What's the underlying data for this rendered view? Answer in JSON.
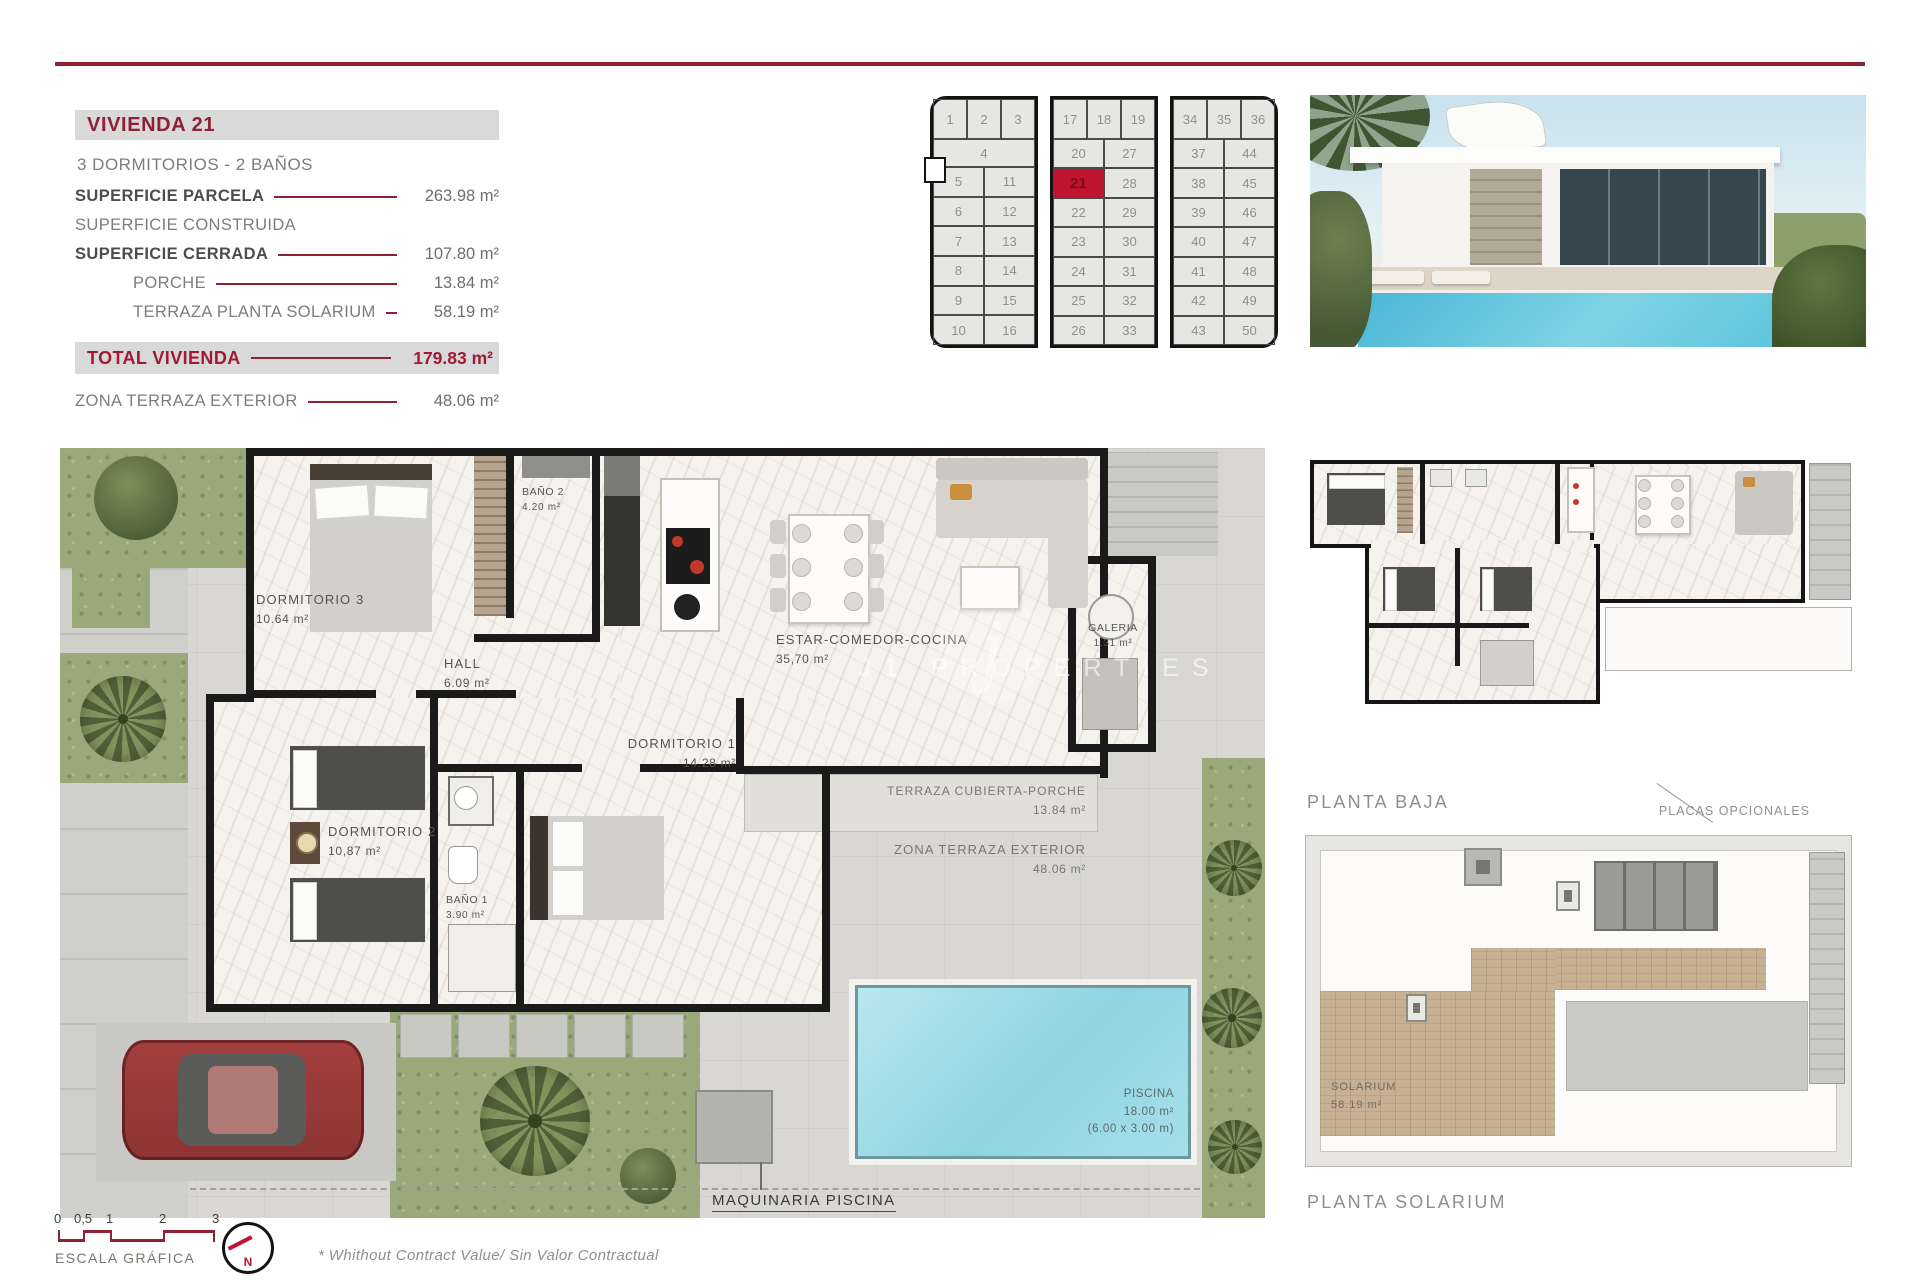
{
  "info_panel": {
    "title": "VIVIENDA 21",
    "subtitle": "3 DORMITORIOS - 2 BAÑOS",
    "rows": [
      {
        "label": "SUPERFICIE PARCELA",
        "value": "263.98 m²"
      },
      {
        "label": "SUPERFICIE CONSTRUIDA",
        "value": ""
      },
      {
        "label": "SUPERFICIE CERRADA",
        "value": "107.80 m²"
      },
      {
        "label": "PORCHE",
        "value": "13.84 m²"
      },
      {
        "label": "TERRAZA PLANTA SOLARIUM",
        "value": "58.19 m²"
      }
    ],
    "total": {
      "label": "TOTAL VIVIENDA",
      "value": "179.83 m²"
    },
    "zona": {
      "label": "ZONA TERRAZA EXTERIOR",
      "value": "48.06 m²"
    }
  },
  "plot_grid": {
    "highlight_plot": "21",
    "blocks": [
      {
        "top": [
          "1",
          "2",
          "3"
        ],
        "wide": "4",
        "pairs": [
          [
            "5",
            "11"
          ],
          [
            "6",
            "12"
          ],
          [
            "7",
            "13"
          ],
          [
            "8",
            "14"
          ],
          [
            "9",
            "15"
          ],
          [
            "10",
            "16"
          ]
        ]
      },
      {
        "top": [
          "17",
          "18",
          "19"
        ],
        "pairs": [
          [
            "20",
            "27"
          ],
          [
            "21",
            "28"
          ],
          [
            "22",
            "29"
          ],
          [
            "23",
            "30"
          ],
          [
            "24",
            "31"
          ],
          [
            "25",
            "32"
          ],
          [
            "26",
            "33"
          ]
        ]
      },
      {
        "top": [
          "34",
          "35",
          "36"
        ],
        "pairs": [
          [
            "37",
            "44"
          ],
          [
            "38",
            "45"
          ],
          [
            "39",
            "46"
          ],
          [
            "40",
            "47"
          ],
          [
            "41",
            "48"
          ],
          [
            "42",
            "49"
          ],
          [
            "43",
            "50"
          ]
        ]
      }
    ]
  },
  "floor_plan": {
    "rooms": [
      {
        "name": "DORMITORIO 3",
        "area": "10.64 m²"
      },
      {
        "name": "BAÑO 2",
        "area": "4.20 m²"
      },
      {
        "name": "HALL",
        "area": "6.09 m²"
      },
      {
        "name": "ESTAR-COMEDOR-COCINA",
        "area": "35,70 m²"
      },
      {
        "name": "GALERIA",
        "area": "1.31 m²"
      },
      {
        "name": "DORMITORIO 1",
        "area": "14.28 m²"
      },
      {
        "name": "DORMITORIO 2",
        "area": "10,87 m²"
      },
      {
        "name": "BAÑO 1",
        "area": "3.90 m²"
      },
      {
        "name": "TERRAZA CUBIERTA-PORCHE",
        "area": "13.84 m²"
      },
      {
        "name": "ZONA TERRAZA EXTERIOR",
        "area": "48.06 m²"
      },
      {
        "name": "PISCINA",
        "area": "18.00 m²",
        "note": "(6.00 x 3.00 m)"
      }
    ],
    "maquinaria_label": "MAQUINARIA PISCINA",
    "watermark": {
      "letter": "j",
      "text": "J1 PROPERTIES"
    }
  },
  "side_plans": {
    "planta_baja_label": "PLANTA BAJA",
    "planta_solarium_label": "PLANTA SOLARIUM",
    "placas_label": "PLACAS OPCIONALES",
    "solarium_room": {
      "name": "SOLARIUM",
      "area": "58.19 m²"
    }
  },
  "footer": {
    "scale_ticks": [
      "0",
      "0,5",
      "1",
      "2",
      "3"
    ],
    "scale_label": "ESCALA GRÁFICA",
    "north_label": "N",
    "disclaimer": "*  Whithout Contract Value/ Sin Valor Contractual"
  },
  "colors": {
    "maroon": "#8e2135",
    "total_red": "#9e1b32",
    "plot_highlight": "#c01531",
    "bar_gray": "#d9d9d9",
    "pool_cyan": "#8fd4e0",
    "grass_green": "#9aa87a",
    "deck_wood": "#c8b092",
    "wall_black": "#1a1a1a"
  }
}
